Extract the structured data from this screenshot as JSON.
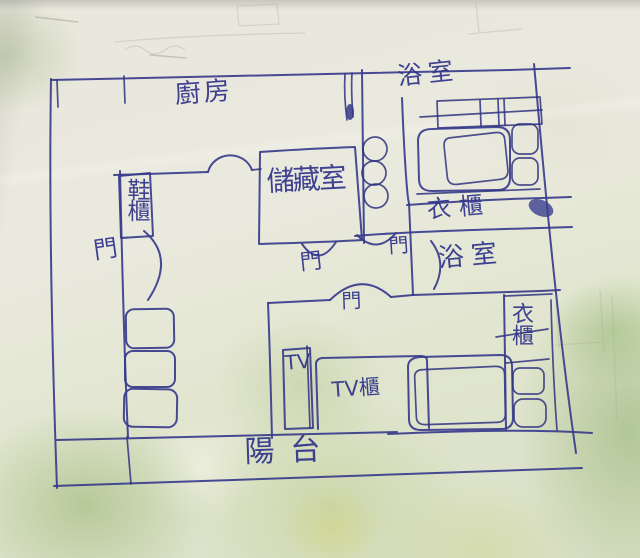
{
  "photo": {
    "kind": "hand-drawn floor plan sketch, blue ballpoint pen on paper",
    "ink_color": "#383c8c",
    "paper_color": "#e9e8dd",
    "blotch_green": "#a8c37c"
  },
  "rooms": {
    "kitchen": {
      "label": "廚房"
    },
    "bathroom_top": {
      "label": "浴室"
    },
    "storage_room": {
      "label": "儲藏室"
    },
    "bathroom_middle": {
      "label": "浴室"
    },
    "balcony": {
      "label": "陽台"
    }
  },
  "furniture": {
    "shoe_cabinet": {
      "label": "鞋櫃"
    },
    "wardrobe_middle": {
      "label": "衣櫃"
    },
    "wardrobe_bedroom": {
      "label": "衣櫃"
    },
    "tv": {
      "label": "TV"
    },
    "tv_cabinet": {
      "label": "TV櫃"
    }
  },
  "doors": [
    {
      "label": "門"
    },
    {
      "label": "門"
    },
    {
      "label": "門"
    },
    {
      "label": "門"
    }
  ]
}
